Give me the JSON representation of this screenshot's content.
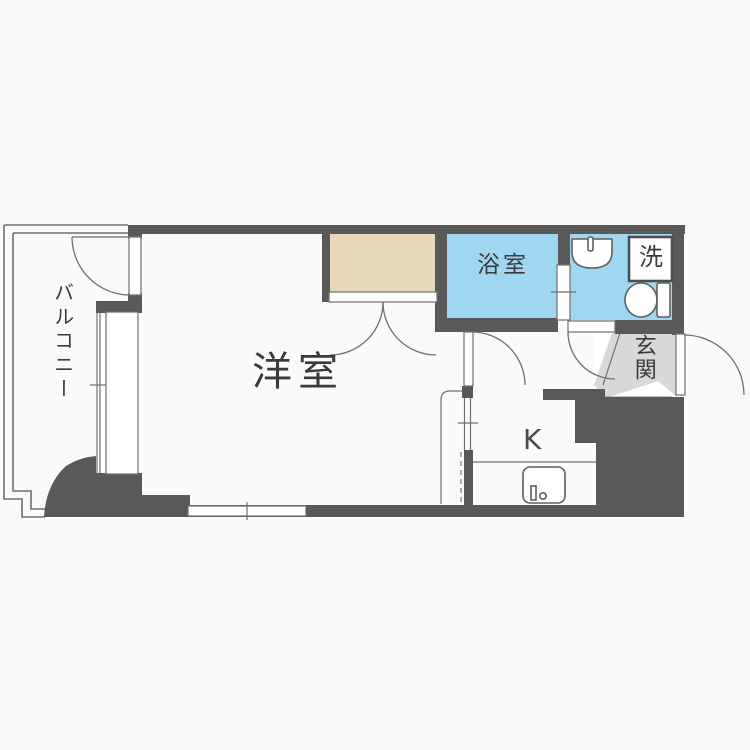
{
  "floor_plan": {
    "type": "apartment-floor-plan",
    "rooms": [
      {
        "id": "balcony",
        "label": "バルコニー"
      },
      {
        "id": "western-room",
        "label": "洋室"
      },
      {
        "id": "bathroom",
        "label": "浴室"
      },
      {
        "id": "washer-space",
        "label": "洗"
      },
      {
        "id": "entrance",
        "label": "玄関"
      },
      {
        "id": "kitchen",
        "label": "K"
      }
    ],
    "fixtures": [
      "closet-double-door",
      "bathroom-sliding-door",
      "washbasin",
      "toilet",
      "washing-machine-pan",
      "entrance-door",
      "shoe-cabinet",
      "kitchen-sink",
      "balcony-door",
      "window",
      "room-partition-door"
    ],
    "colors": {
      "wall": "#595959",
      "line": "#6f6f6f",
      "bathroom_floor": "#9fd6f0",
      "closet_floor": "#e8d7ba",
      "entrance_floor": "#d8d8d8",
      "background": "#fbfaf9",
      "text": "#3a3a3a"
    }
  }
}
